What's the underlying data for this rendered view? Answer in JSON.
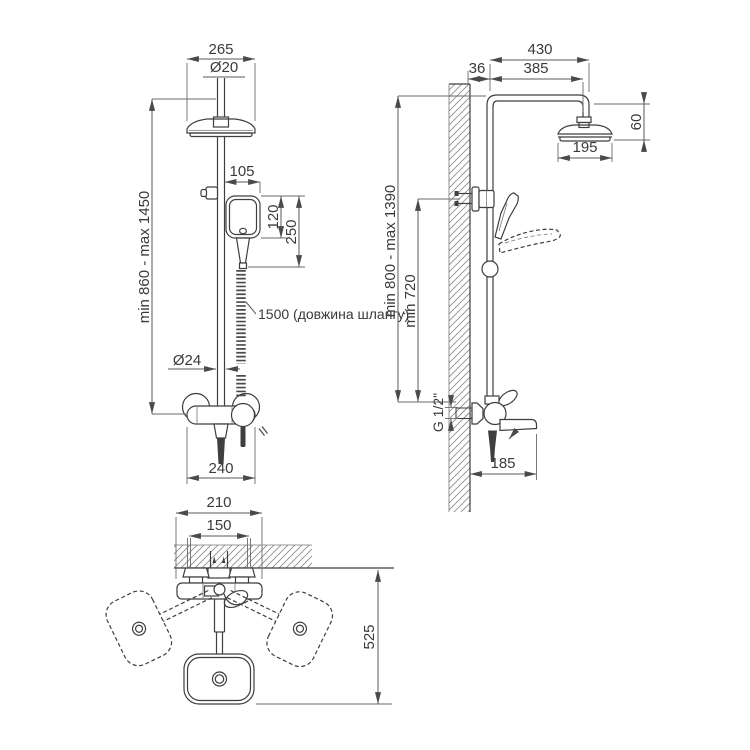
{
  "title": "Shower column dimensional drawing",
  "colors": {
    "background": "#ffffff",
    "line": "#3e3e3e",
    "dim": "#5a5a5a",
    "text": "#3a3a3a"
  },
  "front_view": {
    "overhead_width": "265",
    "pipe_diameter": "Ø20",
    "hand_shower_offset": "105",
    "hand_head_height": "120",
    "hand_shower_length": "250",
    "height_range": "min 860 - max 1450",
    "hose_length": "1500 (довжина шлангу)",
    "riser_diameter": "Ø24",
    "mixer_width": "240"
  },
  "side_view": {
    "arm_reach_total": "430",
    "wall_offset": "36",
    "arm_reach": "385",
    "head_drop": "60",
    "head_diameter": "195",
    "height_range": "min 800 - max 1390",
    "riser_min_height": "min 720",
    "thread": "G 1/2\"",
    "spout_reach": "185"
  },
  "top_view": {
    "body_width": "210",
    "centers_distance": "150",
    "swivel_reach": "525"
  }
}
